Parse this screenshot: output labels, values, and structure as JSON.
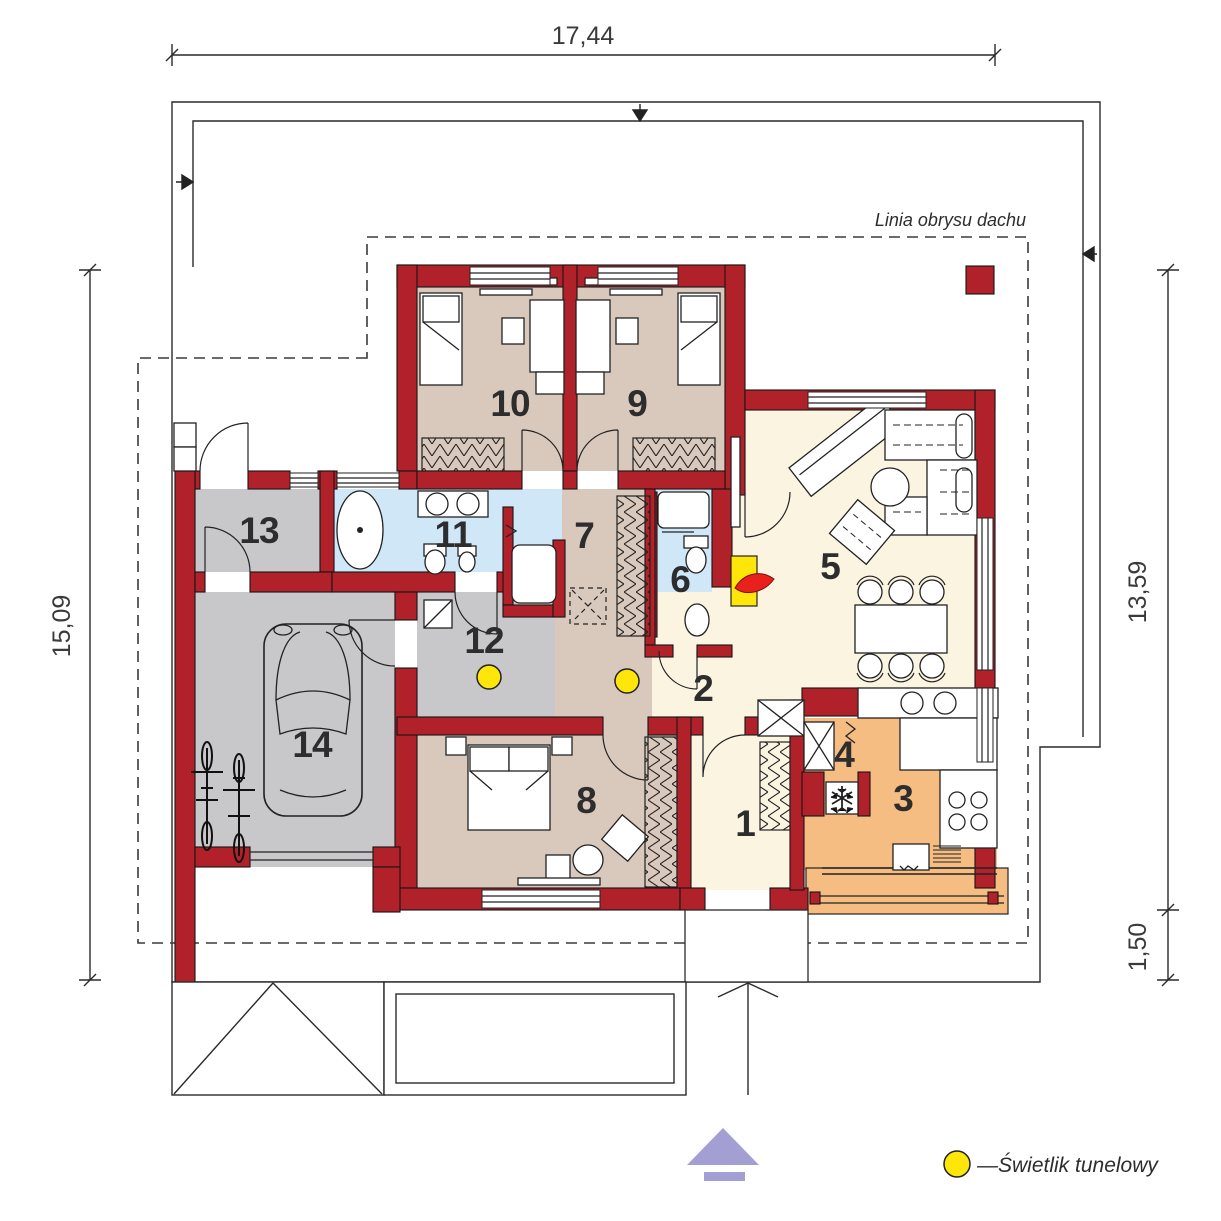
{
  "plan": {
    "dimensions": {
      "top": "17,44",
      "left": "15,09",
      "right_upper": "13,59",
      "right_lower": "1,50"
    },
    "roof_outline_label": "Linia obrysu dachu",
    "legend": {
      "skylight_label": "—Świetlik tunelowy"
    },
    "rooms": [
      {
        "number": "1"
      },
      {
        "number": "2"
      },
      {
        "number": "3"
      },
      {
        "number": "4"
      },
      {
        "number": "5"
      },
      {
        "number": "6"
      },
      {
        "number": "7"
      },
      {
        "number": "8"
      },
      {
        "number": "9"
      },
      {
        "number": "10"
      },
      {
        "number": "11"
      },
      {
        "number": "12"
      },
      {
        "number": "13"
      },
      {
        "number": "14"
      }
    ],
    "icons": {
      "skylight": "yellow-dot",
      "entrance_marker": "purple-up-arrow",
      "fireplace": "red-flame",
      "fridge": "snowflake",
      "chimney": "red-square",
      "attic_hatch": "dashed-x-square"
    },
    "colors": {
      "wall": "#b1212a",
      "bedroom": "#d9c8bc",
      "bathroom": "#cfe7f7",
      "garage_hall": "#c8c7c9",
      "living": "#faf4e1",
      "kitchen": "#f6bd82",
      "skylight": "#ffe60a",
      "entrance_arrow": "#a49fd3"
    }
  }
}
